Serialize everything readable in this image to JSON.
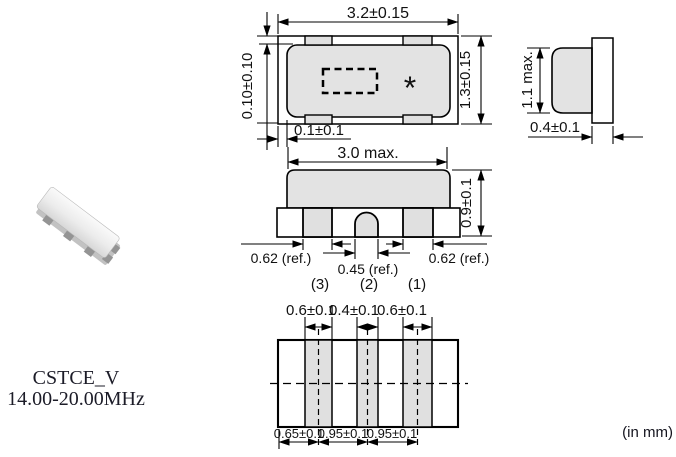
{
  "product": {
    "name": "CSTCE_V",
    "frequency_range": "14.00-20.00MHz",
    "units_note": "(in mm)",
    "marking": "*"
  },
  "views": {
    "top": {
      "width_dim": "3.2±0.15",
      "height_dim": "1.3±0.15",
      "edge_margin_dim": "0.10±0.10",
      "side_margin_dim": "0.1±0.1"
    },
    "side": {
      "height_dim": "1.1 max.",
      "substrate_thickness_dim": "0.4±0.1"
    },
    "front": {
      "cap_width_dim": "3.0 max.",
      "cap_height_dim": "0.9±0.1",
      "pad_left_dim": "0.62 (ref.)",
      "pad_center_dim": "0.45 (ref.)",
      "pad_right_dim": "0.62 (ref.)",
      "terminal_3": "(3)",
      "terminal_2": "(2)",
      "terminal_1": "(1)"
    },
    "bottom": {
      "electrode1_width_dim": "0.6±0.1",
      "electrode2_width_dim": "0.4±0.1",
      "electrode3_width_dim": "0.6±0.1",
      "pitch1_dim": "0.65±0.1",
      "pitch2_dim": "0.95±0.1",
      "pitch3_dim": "0.95±0.1"
    }
  },
  "colors": {
    "body_fill": "#e3e3e3",
    "pad_fill": "#e0e0e0",
    "line": "#000000"
  }
}
